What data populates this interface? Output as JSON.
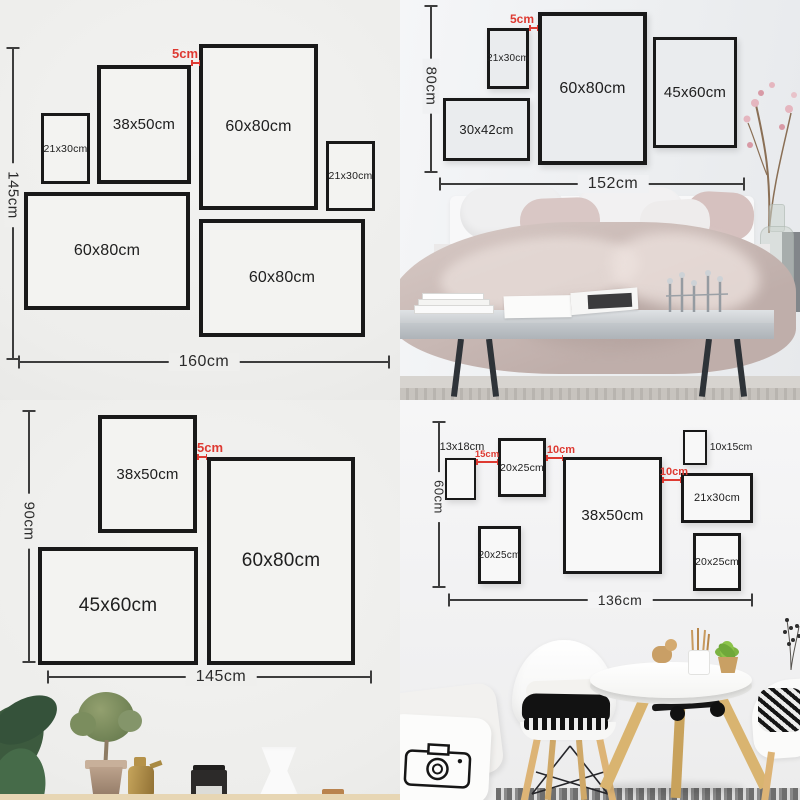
{
  "colors": {
    "red": "#de3a32",
    "frame": "#191919",
    "dim": "#3d3d3d"
  },
  "q1": {
    "height": "145cm",
    "width": "160cm",
    "gap": "5cm",
    "frames": [
      "21x30cm",
      "38x50cm",
      "60x80cm",
      "21x30cm",
      "60x80cm",
      "60x80cm"
    ]
  },
  "q2": {
    "height": "80cm",
    "width": "152cm",
    "gap": "5cm",
    "frames": [
      "21x30cm",
      "60x80cm",
      "45x60cm",
      "30x42cm"
    ]
  },
  "q3": {
    "height": "90cm",
    "width": "145cm",
    "gap": "5cm",
    "frames": [
      "38x50cm",
      "60x80cm",
      "45x60cm"
    ]
  },
  "q4": {
    "height": "60cm",
    "width": "136cm",
    "gaps": [
      "15cm",
      "10cm",
      "10cm"
    ],
    "frames": [
      "20x25cm",
      "38x50cm",
      "21x30cm",
      "20x25cm",
      "20x25cm"
    ],
    "outside": [
      "13x18cm",
      "10x15cm"
    ]
  }
}
